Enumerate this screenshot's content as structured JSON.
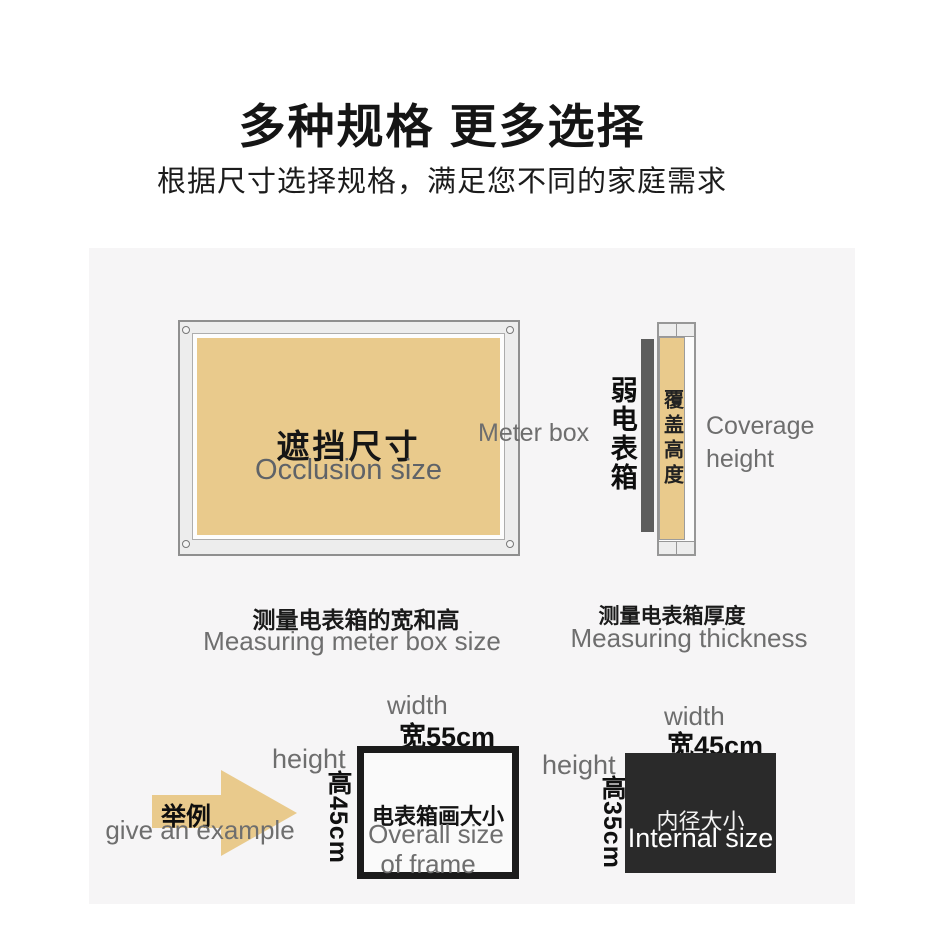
{
  "header": {
    "title": "多种规格 更多选择",
    "subtitle": "根据尺寸选择规格，满足您不同的家庭需求"
  },
  "front_view": {
    "occlusion_cn": "遮挡尺寸",
    "occlusion_en": "Occlusion size",
    "meter_box_label": "Meter box",
    "caption_cn": "测量电表箱的宽和高",
    "caption_en": "Measuring meter box size"
  },
  "side_view": {
    "box_cn": "弱电表箱",
    "cover_cn": "覆盖高度",
    "coverage_en": "Coverage height",
    "caption_cn": "测量电表箱厚度",
    "caption_en": "Measuring thickness"
  },
  "example": {
    "intro_cn": "举例",
    "intro_en": "give an example",
    "outer": {
      "width_en": "width",
      "width_cn": "宽55cm",
      "height_en": "height",
      "height_cn": "高45cm",
      "label_cn": "电表箱画大小",
      "label_en_line1": "Overall size",
      "label_en_line2": "of frame"
    },
    "inner": {
      "width_en": "width",
      "width_cn": "宽45cm",
      "height_en": "height",
      "height_cn": "高35cm",
      "label_cn": "内径大小",
      "label_en": "Internal size"
    }
  },
  "colors": {
    "accent_tan": "#e9ca8c",
    "panel_bg": "#f6f5f6",
    "meter_box_bar": "#5d5d5d",
    "internal_box_bg": "#2a2a2a",
    "outer_frame_border": "#1b1b1b",
    "gray_text": "#6e6e6e",
    "black_text": "#111111"
  }
}
